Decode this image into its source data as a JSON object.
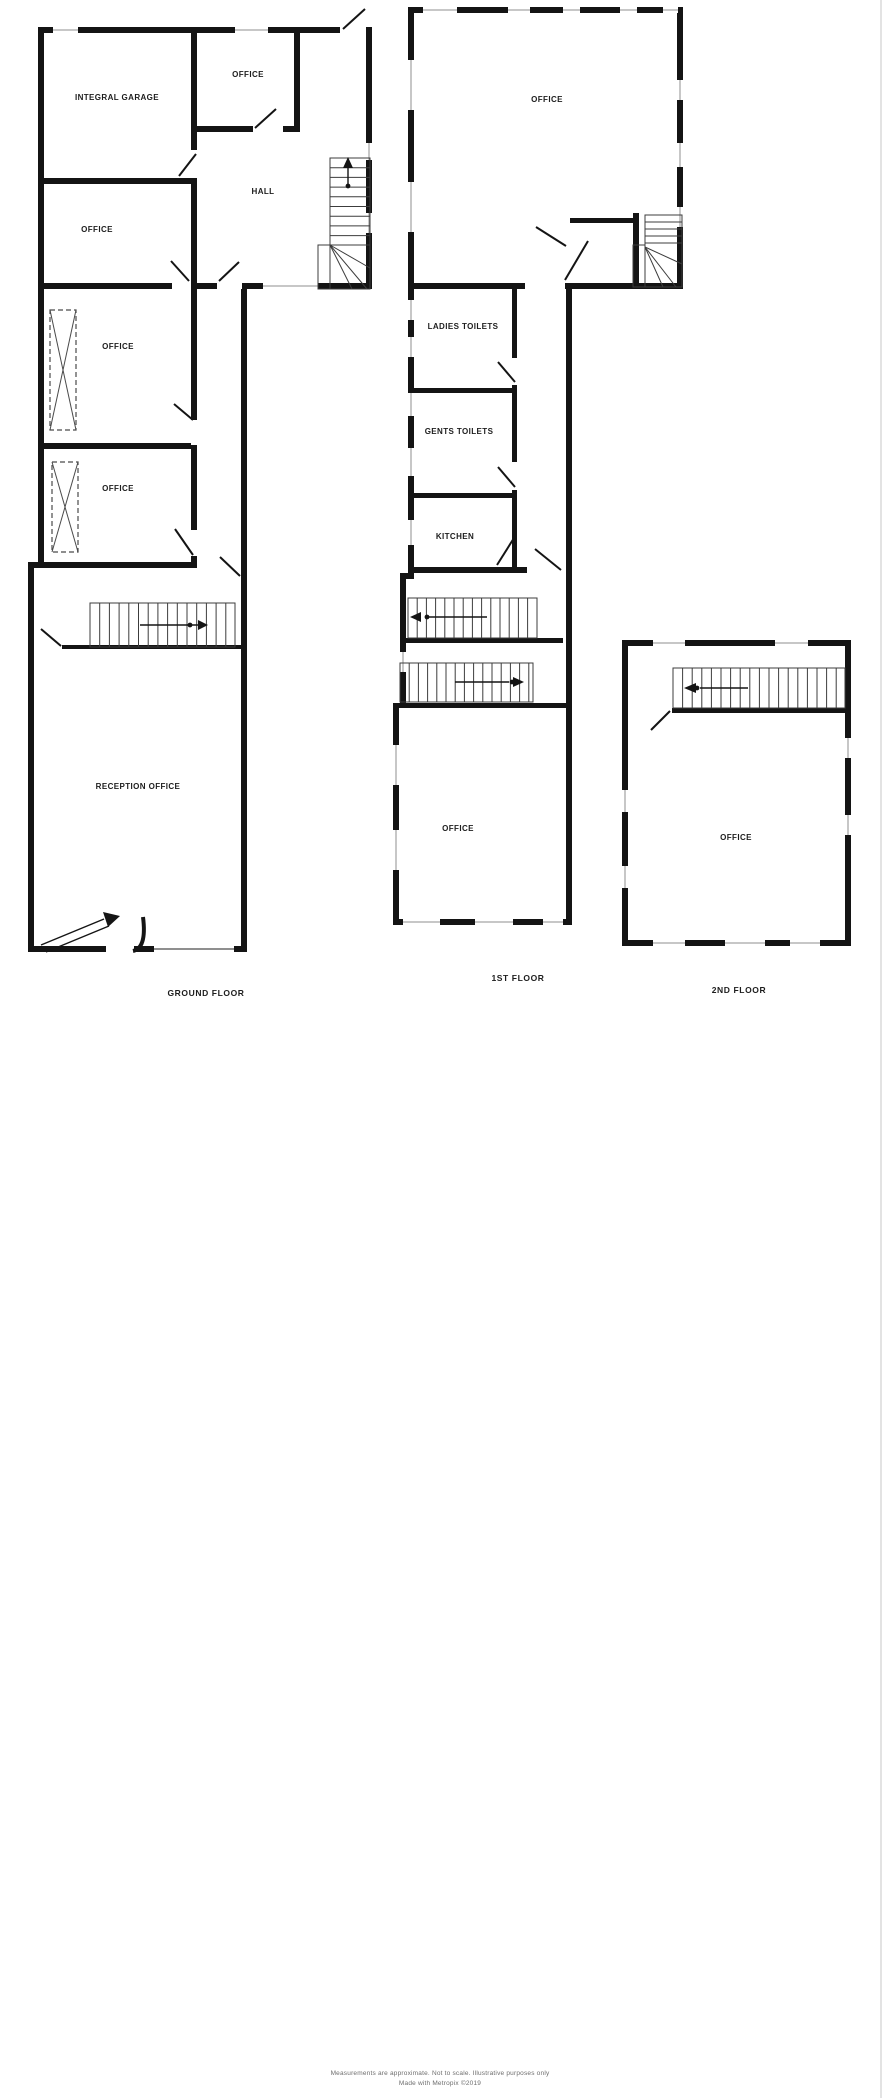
{
  "document_type": "property-floorplan",
  "colors": {
    "wall": "#141414",
    "background": "#ffffff"
  },
  "floors": {
    "ground": {
      "label": "GROUND FLOOR",
      "rooms": {
        "garage": "INTEGRAL GARAGE",
        "office_top": "OFFICE",
        "hall": "HALL",
        "office_2": "OFFICE",
        "office_3": "OFFICE",
        "office_4": "OFFICE",
        "reception": "RECEPTION OFFICE"
      }
    },
    "first": {
      "label": "1ST FLOOR",
      "rooms": {
        "office_top": "OFFICE",
        "ladies": "LADIES TOILETS",
        "gents": "GENTS TOILETS",
        "kitchen": "KITCHEN",
        "office_bottom": "OFFICE"
      }
    },
    "second": {
      "label": "2ND FLOOR",
      "rooms": {
        "office": "OFFICE"
      }
    }
  },
  "footer": {
    "line1": "Measurements are approximate.  Not to scale.  Illustrative purposes only",
    "line2": "Made with Metropix ©2019"
  }
}
